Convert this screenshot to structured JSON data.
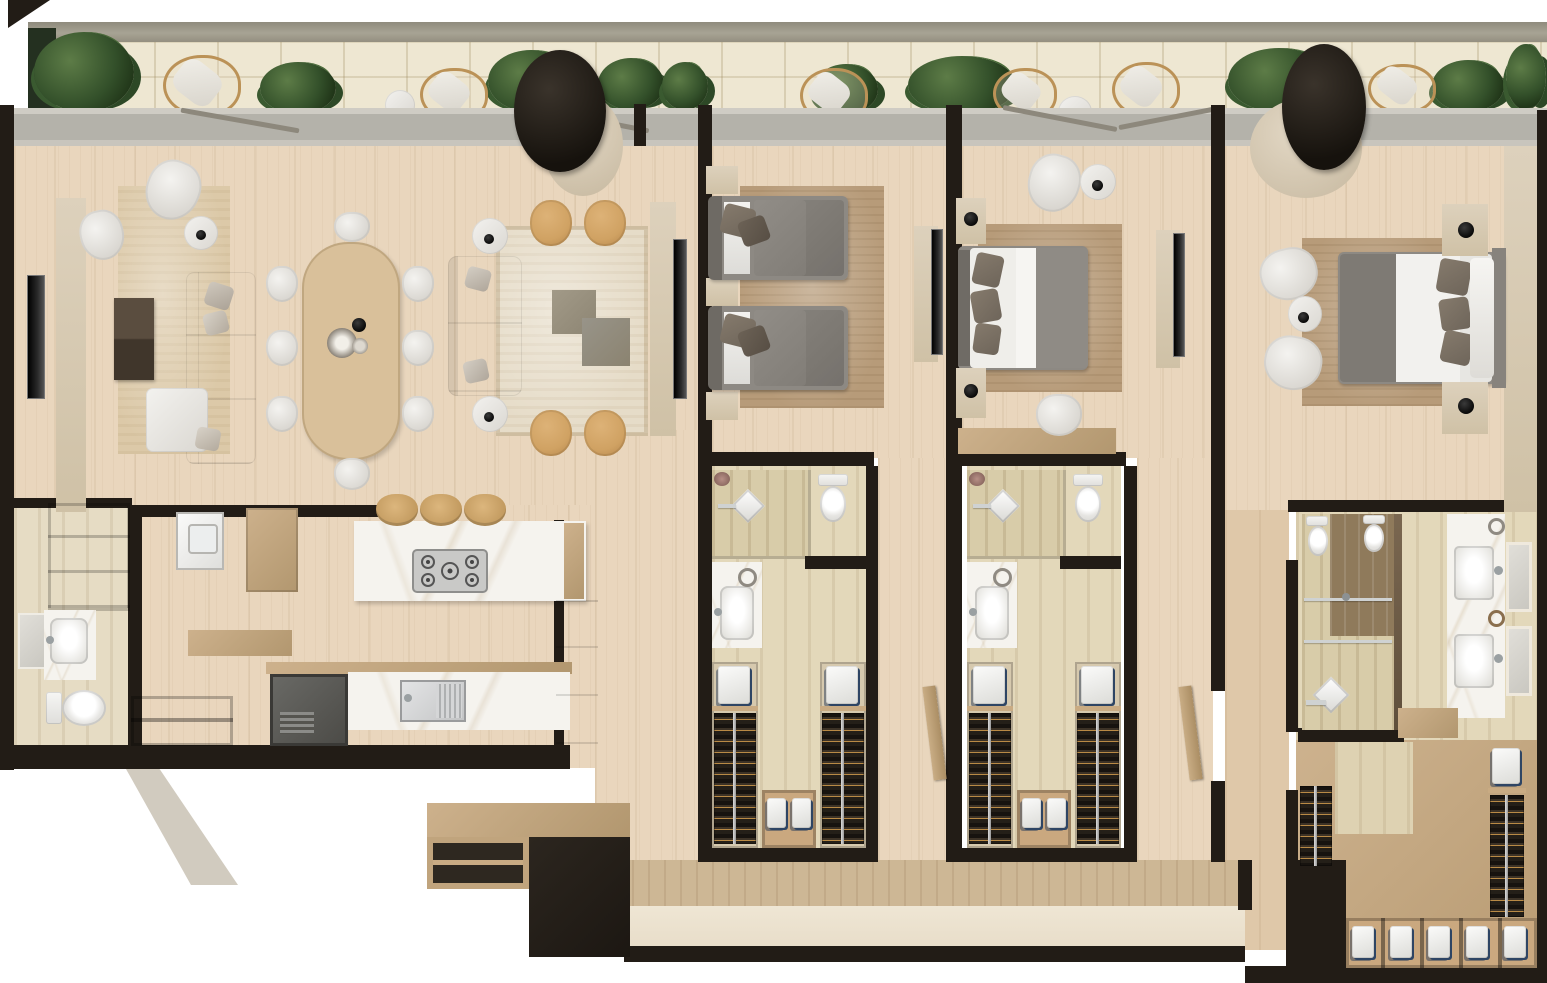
{
  "document": {
    "kind": "residential-floor-plan",
    "style": "3d-rendered-top-view",
    "units_text_visible": false
  },
  "palette": {
    "bg": "#ffffff",
    "wall": "#221c16",
    "wood": "#e9d6bd",
    "wood_dark": "#dfc8a9",
    "tile": "#e3d8ba",
    "balcony_tile": "#eee7d2",
    "glass": "#b4b2aa",
    "marble": "#f5f3ee",
    "tan": "#c3a57f",
    "tan_light": "#d9cdb8",
    "white_furniture": "#efeeea",
    "bed_gray": "#8d8983",
    "rug_beige": "#dcc9a8",
    "rug_brown": "#b79b79",
    "chair_tan": "#d0a263",
    "table_dark": "#51453a",
    "plant_green": "#33502a",
    "corridor": "#e8ddc9",
    "wood_face": "#cdb795",
    "steel": "#c9c9c7"
  },
  "balcony": {
    "planters": 10,
    "wicker_lounge_chairs": 6,
    "side_tables": 2,
    "hanging_egg_chairs": 2,
    "floor": "cream-stone-tiles",
    "rail": "continuous-top-rail",
    "glazing": "full-width-glass-wall"
  },
  "rooms": [
    {
      "id": "living-room",
      "floor": "light-oak",
      "furniture": [
        "wall-tv",
        "media-ledge",
        "coffee-table-dark",
        "area-rug",
        "lounge-chair",
        "armchair",
        "round-side-table",
        "l-shaped-sofa"
      ]
    },
    {
      "id": "dining-area",
      "floor": "light-oak",
      "furniture": [
        "oval-dining-table",
        "dining-chairs-x8",
        "centerpiece-set"
      ]
    },
    {
      "id": "family-lounge",
      "floor": "light-oak",
      "furniture": [
        "sofa",
        "square-coffee-tables-x2",
        "tan-accent-chairs-x4",
        "round-side-tables-x2",
        "wall-tv",
        "hanging-egg-chair"
      ]
    },
    {
      "id": "kitchen",
      "floor": "light-oak",
      "furniture": [
        "marble-island",
        "gas-cooktop-5-burner",
        "bar-stools-x3",
        "marble-counter",
        "double-sink",
        "built-in-fridge",
        "tall-cabinets"
      ]
    },
    {
      "id": "utility-room",
      "floor": "light-oak",
      "furniture": [
        "washing-machine",
        "wardrobe-cabinet",
        "work-shelf",
        "open-shelf-unit"
      ]
    },
    {
      "id": "powder-room",
      "floor": "stone-tile",
      "furniture": [
        "storage-cabinet",
        "mirror",
        "marble-vanity",
        "sink",
        "toilet"
      ]
    },
    {
      "id": "bedroom-1",
      "floor": "light-oak",
      "furniture": [
        "twin-beds-x2",
        "nightstands-x3",
        "area-rug",
        "wall-tv"
      ]
    },
    {
      "id": "bathroom-1",
      "floor": "travertine",
      "furniture": [
        "walk-in-shower",
        "toilet",
        "marble-vanity-sink"
      ]
    },
    {
      "id": "walk-in-closet-1",
      "furniture": [
        "hanging-rails-x2",
        "folded-linen-shelves",
        "shoe-cubbies"
      ]
    },
    {
      "id": "bedroom-2",
      "floor": "light-oak",
      "furniture": [
        "double-bed",
        "nightstands-x2",
        "armchair",
        "round-side-table",
        "desk",
        "desk-chair",
        "area-rug",
        "wall-tv"
      ]
    },
    {
      "id": "bathroom-2",
      "floor": "travertine",
      "furniture": [
        "walk-in-shower",
        "toilet",
        "marble-vanity-sink"
      ]
    },
    {
      "id": "walk-in-closet-2",
      "furniture": [
        "hanging-rails-x2",
        "folded-linen-shelves",
        "shoe-cubbies"
      ]
    },
    {
      "id": "master-bedroom",
      "floor": "light-oak",
      "furniture": [
        "double-bed",
        "nightstands-x2",
        "table-lamps-x2",
        "armchairs-x2",
        "round-side-table",
        "hanging-egg-chair",
        "area-rug"
      ]
    },
    {
      "id": "master-bathroom",
      "floor": "travertine",
      "furniture": [
        "toilet",
        "bidet",
        "walk-in-shower",
        "double-marble-vanity",
        "mirrors-x2",
        "glass-partition"
      ]
    },
    {
      "id": "master-closet",
      "furniture": [
        "hanging-rails-x2",
        "folded-linen-stacks",
        "shoe-cubby-row-x5"
      ]
    },
    {
      "id": "entry-hall",
      "floor": "stone",
      "furniture": [
        "bench-shelf-unit",
        "step-platform"
      ]
    },
    {
      "id": "corridor",
      "floor": "stone",
      "furniture": []
    }
  ]
}
